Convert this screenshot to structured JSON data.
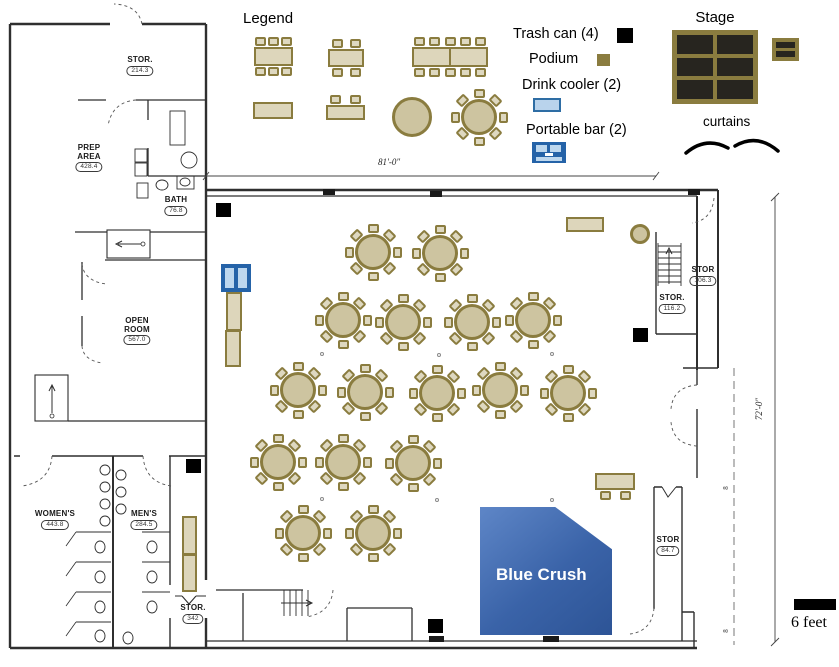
{
  "palette": {
    "tan_fill": "#ddd6bb",
    "tan_border": "#8a7c3f",
    "round_fill": "#cdc4a0",
    "chair_fill": "#ded8c0",
    "stage_dark": "#27251f",
    "bar_frame": "#2563a8",
    "bar_cell": "#bdd7ee",
    "cooler_fill": "#b9d3ec",
    "cooler_border": "#2e6da4",
    "trash": "#000000",
    "zone_start": "#5e86c7",
    "zone_end": "#2d5496"
  },
  "legend": {
    "heading": "Legend",
    "items": [
      {
        "id": "trash-can",
        "label": "Trash can (4)"
      },
      {
        "id": "podium",
        "label": "Podium"
      },
      {
        "id": "drink-cooler",
        "label": "Drink cooler (2)"
      },
      {
        "id": "portable-bar",
        "label": "Portable bar (2)"
      }
    ],
    "sample_icons": [
      "table-6-chairs",
      "table-4-chairs",
      "table-10-chairs",
      "rect-table",
      "serving-table-2-chairs",
      "round-table-plain",
      "round-table-8-chairs"
    ]
  },
  "stage": {
    "label": "Stage",
    "curtains_label": "curtains"
  },
  "dimensions": {
    "width_label": "81'-0\"",
    "height_label": "72'-0\"",
    "column_marks": [
      "8",
      "8"
    ],
    "scale_label": "6 feet"
  },
  "zone": {
    "label": "Blue Crush"
  },
  "rooms": [
    {
      "lines": [
        "STOR."
      ],
      "area": "214.3",
      "cx": 140,
      "y": 56
    },
    {
      "lines": [
        "PREP",
        "AREA"
      ],
      "area": "428.4",
      "cx": 89,
      "y": 144
    },
    {
      "lines": [
        "BATH"
      ],
      "area": "76.8",
      "cx": 176,
      "y": 196
    },
    {
      "lines": [
        "OPEN",
        "ROOM"
      ],
      "area": "567.0",
      "cx": 137,
      "y": 317
    },
    {
      "lines": [
        "WOMEN'S"
      ],
      "area": "443.8",
      "cx": 55,
      "y": 510
    },
    {
      "lines": [
        "MEN'S"
      ],
      "area": "284.5",
      "cx": 144,
      "y": 510
    },
    {
      "lines": [
        "STOR."
      ],
      "area": "342",
      "cx": 193,
      "y": 604
    },
    {
      "lines": [
        "STOR"
      ],
      "area": "106.3",
      "cx": 703,
      "y": 266
    },
    {
      "lines": [
        "STOR."
      ],
      "area": "116.2",
      "cx": 672,
      "y": 294
    },
    {
      "lines": [
        "STOR"
      ],
      "area": "84.7",
      "cx": 668,
      "y": 536
    }
  ],
  "furniture": {
    "round_tables": [
      [
        373,
        252
      ],
      [
        440,
        253
      ],
      [
        343,
        320
      ],
      [
        403,
        322
      ],
      [
        472,
        322
      ],
      [
        533,
        320
      ],
      [
        298,
        390
      ],
      [
        365,
        392
      ],
      [
        437,
        393
      ],
      [
        500,
        390
      ],
      [
        568,
        393
      ],
      [
        278,
        462
      ],
      [
        343,
        462
      ],
      [
        413,
        463
      ],
      [
        303,
        533
      ],
      [
        373,
        533
      ]
    ],
    "legend_round_table": [
      479,
      117
    ],
    "plain_circles": [
      {
        "cx": 412,
        "cy": 117,
        "r": 20
      },
      {
        "cx": 640,
        "cy": 234,
        "r": 10
      }
    ],
    "rect_tables": [
      {
        "x": 254,
        "y": 47,
        "w": 39,
        "h": 19,
        "top": 3,
        "bottom": 3
      },
      {
        "x": 328,
        "y": 49,
        "w": 36,
        "h": 18,
        "top": 2,
        "bottom": 2
      },
      {
        "x": 412,
        "y": 47,
        "w": 76,
        "h": 20,
        "top": 5,
        "bottom": 5,
        "divider": true
      },
      {
        "x": 253,
        "y": 102,
        "w": 40,
        "h": 17
      },
      {
        "x": 326,
        "y": 105,
        "w": 39,
        "h": 15,
        "top": 2
      },
      {
        "x": 226,
        "y": 292,
        "w": 16,
        "h": 39
      },
      {
        "x": 225,
        "y": 330,
        "w": 16,
        "h": 37
      },
      {
        "x": 182,
        "y": 516,
        "w": 15,
        "h": 39
      },
      {
        "x": 182,
        "y": 554,
        "w": 15,
        "h": 38
      },
      {
        "x": 566,
        "y": 217,
        "w": 38,
        "h": 15
      },
      {
        "x": 595,
        "y": 473,
        "w": 40,
        "h": 17,
        "bottom": 2
      }
    ],
    "trash_cans": [
      [
        216,
        203
      ],
      [
        186,
        459
      ],
      [
        633,
        328
      ],
      [
        428,
        619
      ]
    ],
    "portable_bars": [
      {
        "x": 221,
        "y": 264,
        "w": 30,
        "h": 28
      }
    ],
    "column_dots": [
      [
        320,
        352
      ],
      [
        437,
        353
      ],
      [
        550,
        352
      ],
      [
        320,
        497
      ],
      [
        435,
        498
      ],
      [
        550,
        498
      ]
    ]
  }
}
